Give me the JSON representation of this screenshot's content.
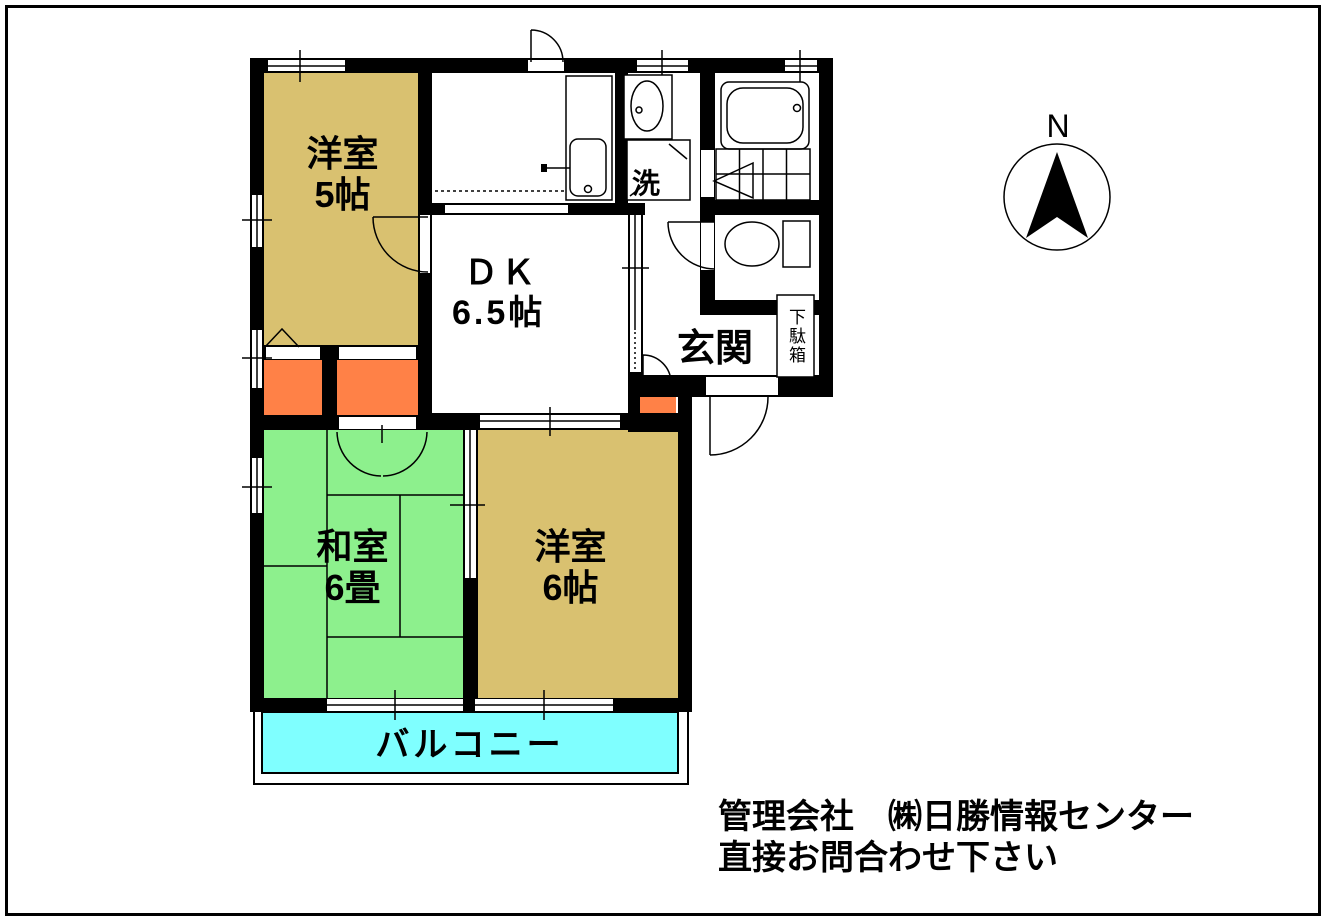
{
  "colors": {
    "western_room": "#d9c170",
    "japanese_room": "#8df08d",
    "balcony": "#7fffff",
    "closet": "#ff8147",
    "wall": "#000000"
  },
  "rooms": {
    "western5": {
      "name": "洋室",
      "size": "5帖"
    },
    "dk": {
      "name": "ＤＫ",
      "size": "6.5帖"
    },
    "japanese6": {
      "name": "和室",
      "size": "6畳"
    },
    "western6": {
      "name": "洋室",
      "size": "6帖"
    },
    "genkan": {
      "name": "玄関"
    },
    "laundry": {
      "name": "洗"
    },
    "shoe_cabinet": {
      "name": "下駄箱"
    },
    "balcony": {
      "name": "バルコニー"
    }
  },
  "compass": {
    "north_label": "N"
  },
  "footer": {
    "line1": "管理会社　㈱日勝情報センター",
    "line2": "直接お問合わせ下さい"
  }
}
